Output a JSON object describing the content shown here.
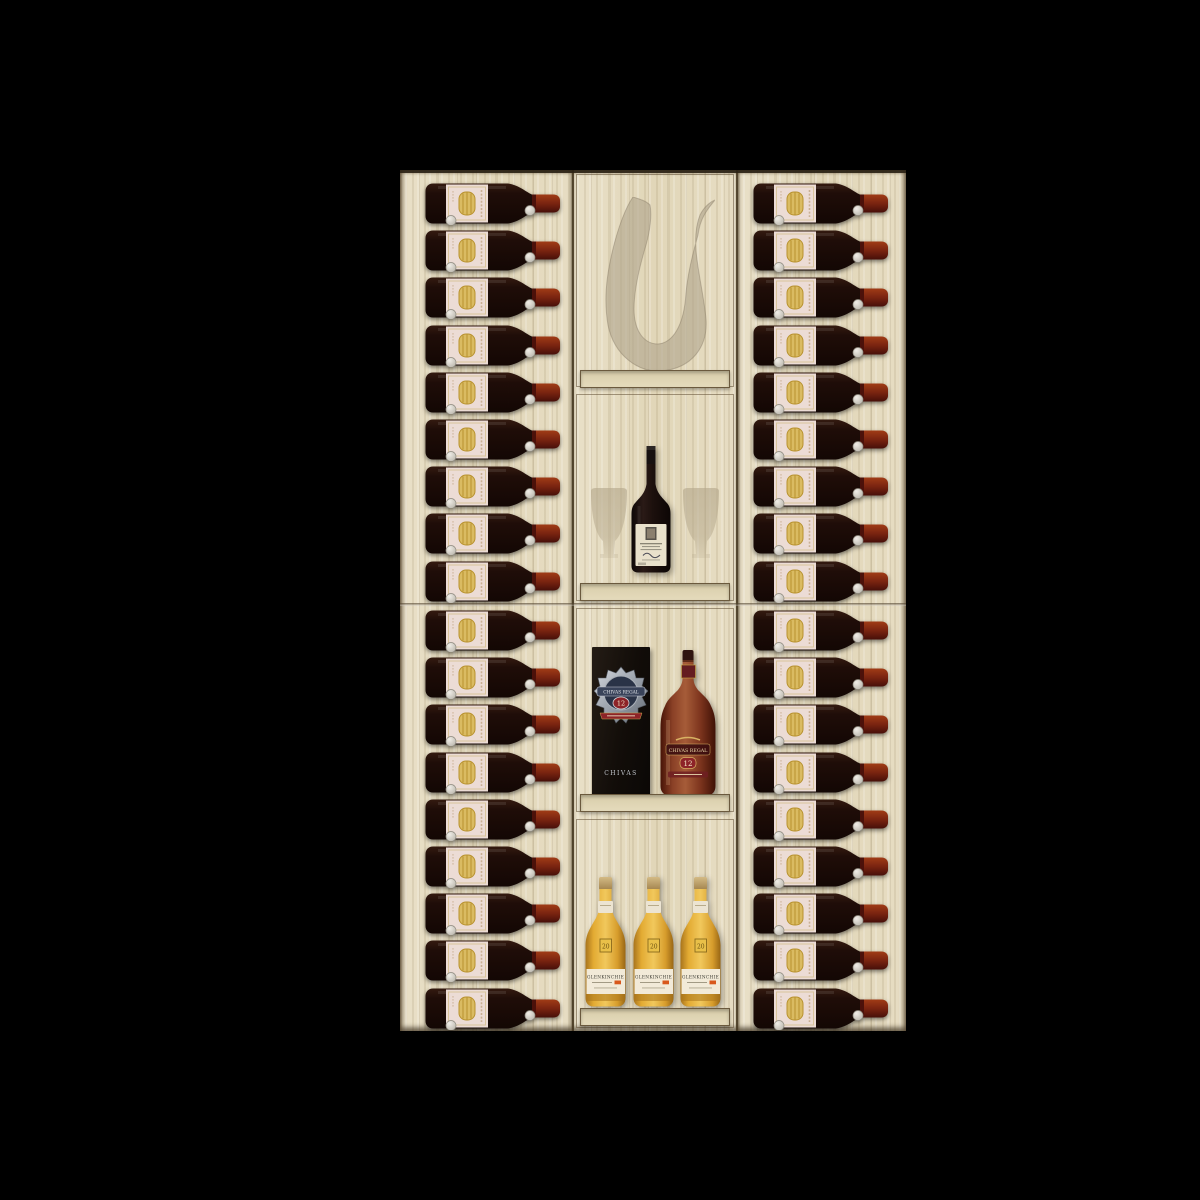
{
  "scene": {
    "name": "wine-cabinet-display",
    "background_color": "#000000",
    "wood_color": "#e5dbc1"
  },
  "rack": {
    "left_column": {
      "rows": 18
    },
    "right_column": {
      "rows": 18
    },
    "wine_bottle": {
      "orientation": "horizontal",
      "glass_color": "#1d0d08",
      "foil_color": "#7a2410",
      "label_color": "#ecdcd5",
      "emblem_color": "#dabb62",
      "peg_color": "#d7d4cd"
    }
  },
  "center_column": {
    "decanter_niche": {
      "item": "glass-decanter-silhouette"
    },
    "wine_niche": {
      "items": [
        "wine-glass-silhouette",
        "standing-wine-bottle",
        "wine-glass-silhouette"
      ],
      "bottle_label_color": "#e9e1cb"
    },
    "whisky_niche": {
      "box": {
        "brand": "CHIVAS REGAL",
        "age": "12",
        "footer": "CHIVAS"
      },
      "bottle": {
        "brand": "CHIVAS REGAL",
        "age": "12"
      }
    },
    "malt_niche": {
      "bottles": [
        {
          "brand": "GLENKINCHIE",
          "badge": "20"
        },
        {
          "brand": "GLENKINCHIE",
          "badge": "20"
        },
        {
          "brand": "GLENKINCHIE",
          "badge": "20"
        }
      ]
    }
  }
}
